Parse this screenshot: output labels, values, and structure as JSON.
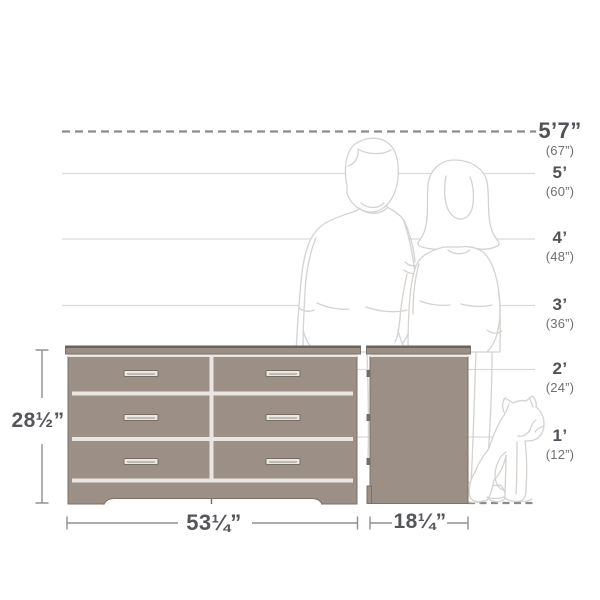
{
  "scale": {
    "marks": [
      {
        "label": "5’7”",
        "sub": "(67”)"
      },
      {
        "label": "5’",
        "sub": "(60”)"
      },
      {
        "label": "4’",
        "sub": "(48”)"
      },
      {
        "label": "3’",
        "sub": "(36”)"
      },
      {
        "label": "2’",
        "sub": "(24”)"
      },
      {
        "label": "1’",
        "sub": "(12”)"
      }
    ]
  },
  "measurements": {
    "height": "28½”",
    "width": "53¼”",
    "depth": "18¼”"
  },
  "illustrations": {
    "furniture": "six-drawer-dresser-front-and-side-view",
    "figures": [
      "man-outline",
      "woman-outline",
      "dog-outline"
    ]
  },
  "colors": {
    "furniture_fill": "#9c9086",
    "furniture_edge": "#7a7168",
    "furniture_top_edge": "#6b625a",
    "drawer_gap": "#e9e5e0",
    "handle_fill": "#ece8e3",
    "guide_line": "#dbdbdb",
    "dashed_line": "#8c8c8c",
    "dimension_line": "#8f9093",
    "label_text": "#515257",
    "sub_text": "#6f7073",
    "silhouette_line": "#d5d2cf"
  }
}
